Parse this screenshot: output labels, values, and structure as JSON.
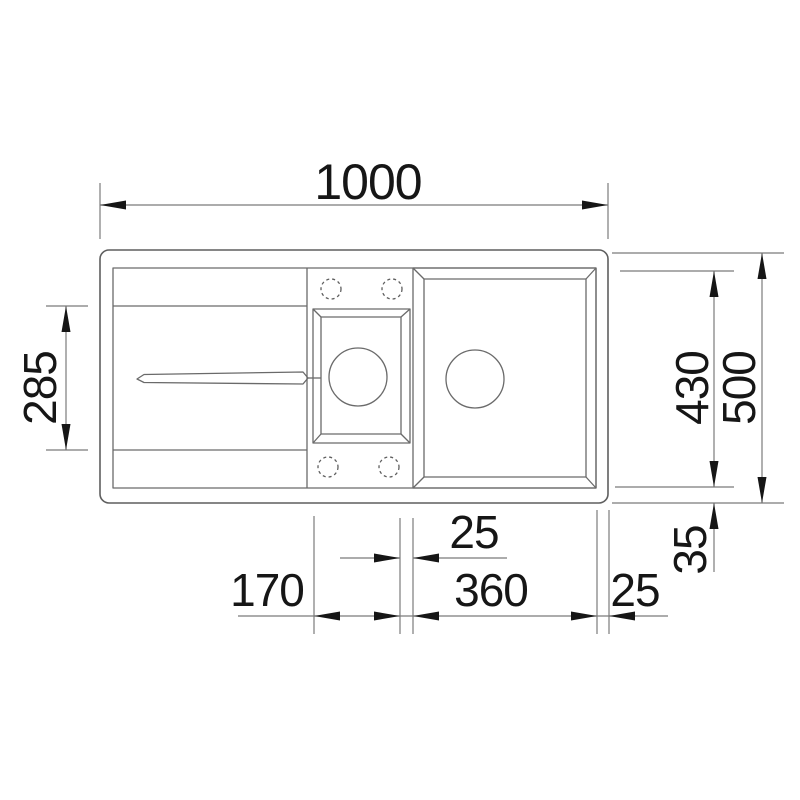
{
  "figure": {
    "type": "technical-drawing",
    "subject": "Inset kitchen sink with drainboard, small bowl and main bowl — top view with dimensions",
    "units": "mm"
  },
  "dimensions": {
    "overall_width": "1000",
    "drainboard_depth": "285",
    "bowl_depth": "430",
    "overall_depth": "500",
    "bottom_rim_offset": "35",
    "bowl_divider_gap": "25",
    "small_bowl_width": "170",
    "main_bowl_width": "360",
    "right_rim_margin": "25"
  },
  "colors": {
    "background": "#ffffff",
    "outline": "#5f5f5f",
    "dimension_lines": "#7b7b7b",
    "ink": "#161616"
  }
}
